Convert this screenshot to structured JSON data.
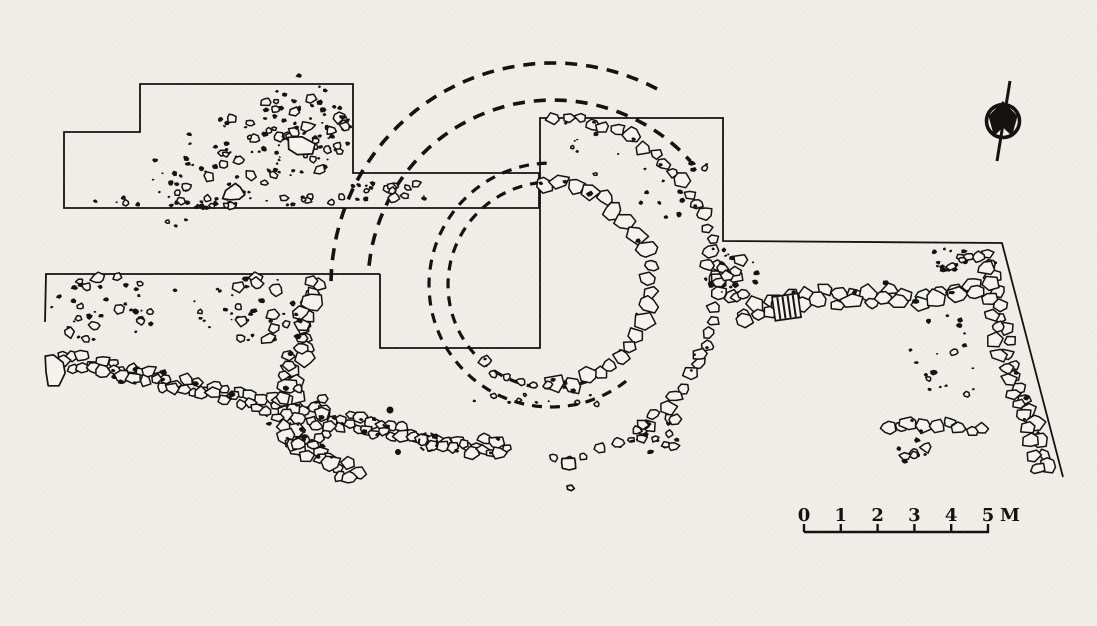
{
  "figure": {
    "type": "archaeological-excavation-site-plan",
    "ink": "#151310",
    "paper": "#f3f1ec",
    "stone_fill": "#f5f3ee",
    "elements": [
      "trench outlines",
      "stone walls",
      "circular stone structure",
      "reconstructed dashed circles",
      "north arrow",
      "scale bar"
    ]
  },
  "scale_bar": {
    "labels": [
      "0",
      "1",
      "2",
      "3",
      "4",
      "5"
    ],
    "unit": "M",
    "interval_m": 1,
    "total_m": 5
  },
  "drawing": {
    "shapes": [
      {
        "name": "outer-dashed-ring-outer",
        "kind": "dashedArc",
        "cx": 553,
        "cy": 285,
        "r": 222,
        "a0": 181,
        "a1": 300,
        "w": 3.6,
        "dash": "12 9"
      },
      {
        "name": "outer-dashed-ring-inner",
        "kind": "dashedArc",
        "cx": 553,
        "cy": 285,
        "r": 185,
        "a0": 186,
        "a1": 320,
        "w": 3.6,
        "dash": "12 9"
      },
      {
        "name": "inner-dashed-ring-outer",
        "kind": "dashedArc",
        "cx": 551,
        "cy": 285,
        "r": 122,
        "a0": 52,
        "a1": 268,
        "w": 3.2,
        "dash": "10 8"
      },
      {
        "name": "inner-dashed-ring-inner",
        "kind": "dashedArc",
        "cx": 551,
        "cy": 285,
        "r": 103,
        "a0": 58,
        "a1": 268,
        "w": 3.2,
        "dash": "10 8"
      },
      {
        "name": "trench-outline-northwest",
        "kind": "poly",
        "closed": true,
        "w": 1.8,
        "pts": [
          [
            140,
            84
          ],
          [
            353,
            84
          ],
          [
            353,
            173
          ],
          [
            539,
            173
          ],
          [
            539,
            208
          ],
          [
            64,
            208
          ],
          [
            64,
            132
          ],
          [
            140,
            132
          ]
        ]
      },
      {
        "name": "trench-outline-central",
        "kind": "poly",
        "closed": false,
        "w": 1.8,
        "pts": [
          [
            380,
            274
          ],
          [
            380,
            348
          ],
          [
            540,
            348
          ],
          [
            540,
            118
          ],
          [
            723,
            118
          ],
          [
            723,
            241
          ],
          [
            1002,
            243
          ],
          [
            1063,
            477
          ]
        ]
      },
      {
        "name": "trench-outline-southwest",
        "kind": "poly",
        "closed": false,
        "w": 1.8,
        "pts": [
          [
            45,
            322
          ],
          [
            46,
            274
          ],
          [
            380,
            274
          ]
        ]
      },
      {
        "name": "inner-ring-wall",
        "kind": "arcWall",
        "cx": 551,
        "cy": 285,
        "r": 100,
        "a0": 266,
        "a1": 450,
        "smin": 12,
        "smax": 19,
        "gap": 0.95,
        "black": 0.22,
        "seed": 11
      },
      {
        "name": "inner-ring-wall-sparse",
        "kind": "arcWall",
        "cx": 551,
        "cy": 285,
        "r": 103,
        "a0": 452,
        "a1": 502,
        "smin": 6,
        "smax": 11,
        "gap": 1.9,
        "black": 0.15,
        "seed": 12
      },
      {
        "name": "outer-ring-wall",
        "kind": "arcWall",
        "cx": 551,
        "cy": 285,
        "r": 167,
        "a0": 271,
        "a1": 388,
        "smin": 9,
        "smax": 15,
        "gap": 1.15,
        "black": 0.3,
        "seed": 13
      },
      {
        "name": "outer-ring-wall-lower",
        "kind": "arcWall",
        "cx": 551,
        "cy": 285,
        "r": 168,
        "a0": 388,
        "a1": 418,
        "smin": 10,
        "smax": 16,
        "gap": 1.05,
        "black": 0.25,
        "seed": 14
      },
      {
        "name": "outer-ring-wall-tail",
        "kind": "arcWall",
        "cx": 551,
        "cy": 285,
        "r": 173,
        "a0": 418,
        "a1": 450,
        "smin": 6,
        "smax": 11,
        "gap": 2.0,
        "black": 0.2,
        "seed": 15
      },
      {
        "name": "east-west-wall",
        "kind": "pathWall",
        "pts": [
          [
            742,
            318
          ],
          [
            765,
            308
          ],
          [
            790,
            300
          ],
          [
            815,
            294
          ],
          [
            845,
            298
          ],
          [
            875,
            295
          ],
          [
            905,
            299
          ],
          [
            935,
            296
          ],
          [
            960,
            290
          ],
          [
            980,
            285
          ]
        ],
        "smin": 11,
        "smax": 18,
        "gap": 1.15,
        "black": 0.28,
        "rows": 1.6,
        "seed": 16
      },
      {
        "name": "east-trench-wall",
        "kind": "pathWall",
        "pts": [
          [
            984,
            252
          ],
          [
            990,
            281
          ],
          [
            995,
            309
          ],
          [
            1001,
            337
          ],
          [
            1009,
            365
          ],
          [
            1017,
            392
          ],
          [
            1027,
            420
          ],
          [
            1037,
            448
          ],
          [
            1045,
            468
          ]
        ],
        "smin": 9,
        "smax": 15,
        "gap": 1.1,
        "black": 0.3,
        "rows": 1.5,
        "seed": 17
      },
      {
        "name": "southeast-wall",
        "kind": "pathWall",
        "pts": [
          [
            886,
            428
          ],
          [
            908,
            423
          ],
          [
            930,
            428
          ],
          [
            952,
            424
          ],
          [
            972,
            429
          ],
          [
            985,
            427
          ]
        ],
        "smin": 9,
        "smax": 15,
        "gap": 1.0,
        "black": 0.28,
        "rows": 1.3,
        "seed": 18
      },
      {
        "name": "southwest-diagonal-wall",
        "kind": "pathWall",
        "pts": [
          [
            62,
            360
          ],
          [
            100,
            368
          ],
          [
            140,
            377
          ],
          [
            180,
            386
          ],
          [
            220,
            394
          ],
          [
            260,
            402
          ],
          [
            300,
            411
          ],
          [
            340,
            420
          ],
          [
            380,
            429
          ],
          [
            420,
            437
          ],
          [
            455,
            443
          ],
          [
            490,
            448
          ],
          [
            510,
            451
          ]
        ],
        "smin": 8,
        "smax": 13,
        "gap": 0.92,
        "black": 0.3,
        "rows": 2,
        "seed": 19
      },
      {
        "name": "south-curved-wall",
        "kind": "pathWall",
        "pts": [
          [
            316,
            280
          ],
          [
            310,
            306
          ],
          [
            303,
            332
          ],
          [
            296,
            358
          ],
          [
            289,
            384
          ],
          [
            287,
            410
          ],
          [
            295,
            436
          ],
          [
            313,
            456
          ],
          [
            336,
            467
          ],
          [
            360,
            472
          ]
        ],
        "smin": 10,
        "smax": 17,
        "gap": 0.85,
        "black": 0.35,
        "rows": 2.4,
        "seed": 20
      },
      {
        "name": "nw-trench-debris",
        "kind": "bandScatter",
        "p1": [
          150,
          198
        ],
        "p2": [
          340,
          102
        ],
        "width": 85,
        "bits": 80,
        "stones": 26,
        "smin": 4,
        "smax": 11,
        "seed": 21
      },
      {
        "name": "nw-dense-cluster",
        "kind": "blobScatter",
        "cx": 295,
        "cy": 135,
        "rx": 52,
        "ry": 42,
        "bits": 40,
        "stones": 16,
        "smin": 4,
        "smax": 11,
        "seed": 35
      },
      {
        "name": "nw-trench-bottom-row",
        "kind": "bandScatter",
        "p1": [
          95,
          202
        ],
        "p2": [
          345,
          200
        ],
        "width": 10,
        "bits": 20,
        "stones": 12,
        "smin": 4,
        "smax": 8,
        "seed": 22
      },
      {
        "name": "nw-corridor-stones",
        "kind": "bandScatter",
        "p1": [
          352,
          194
        ],
        "p2": [
          432,
          190
        ],
        "width": 20,
        "bits": 12,
        "stones": 9,
        "smin": 5,
        "smax": 10,
        "seed": 23
      },
      {
        "name": "sw-trench-northwest-cluster",
        "kind": "blobScatter",
        "cx": 105,
        "cy": 308,
        "rx": 55,
        "ry": 34,
        "bits": 26,
        "stones": 14,
        "smin": 5,
        "smax": 12,
        "seed": 24
      },
      {
        "name": "sw-trench-mid-specks",
        "kind": "blobScatter",
        "cx": 205,
        "cy": 305,
        "rx": 40,
        "ry": 28,
        "bits": 10,
        "stones": 2,
        "smin": 4,
        "smax": 7,
        "seed": 25
      },
      {
        "name": "sw-trench-center-cluster",
        "kind": "blobScatter",
        "cx": 258,
        "cy": 312,
        "rx": 38,
        "ry": 38,
        "bits": 22,
        "stones": 10,
        "smin": 5,
        "smax": 12,
        "seed": 26
      },
      {
        "name": "south-wall-west-bulge",
        "kind": "blobScatter",
        "cx": 295,
        "cy": 420,
        "rx": 36,
        "ry": 34,
        "bits": 14,
        "stones": 12,
        "smin": 7,
        "smax": 14,
        "seed": 27
      },
      {
        "name": "ring-junction-cluster",
        "kind": "blobScatter",
        "cx": 731,
        "cy": 274,
        "rx": 27,
        "ry": 25,
        "bits": 16,
        "stones": 11,
        "smin": 7,
        "smax": 14,
        "seed": 28
      },
      {
        "name": "outer-ring-tail-cluster",
        "kind": "blobScatter",
        "cx": 655,
        "cy": 432,
        "rx": 24,
        "ry": 23,
        "bits": 8,
        "stones": 9,
        "smin": 6,
        "smax": 11,
        "seed": 29
      },
      {
        "name": "between-rings-specks",
        "kind": "bandScatter",
        "p1": [
          575,
          140
        ],
        "p2": [
          690,
          215
        ],
        "width": 40,
        "bits": 14,
        "stones": 2,
        "smin": 3,
        "smax": 5,
        "seed": 30
      },
      {
        "name": "north-corner-specks",
        "kind": "blobScatter",
        "cx": 697,
        "cy": 167,
        "rx": 10,
        "ry": 10,
        "bits": 4,
        "stones": 1,
        "smin": 4,
        "smax": 6,
        "seed": 36
      },
      {
        "name": "east-trench-inner-specks",
        "kind": "blobScatter",
        "cx": 945,
        "cy": 360,
        "rx": 38,
        "ry": 48,
        "bits": 16,
        "stones": 3,
        "smin": 4,
        "smax": 7,
        "seed": 31
      },
      {
        "name": "east-corner-cluster",
        "kind": "blobScatter",
        "cx": 951,
        "cy": 258,
        "rx": 20,
        "ry": 14,
        "bits": 14,
        "stones": 4,
        "smin": 5,
        "smax": 9,
        "seed": 32
      },
      {
        "name": "southeast-below-stones",
        "kind": "blobScatter",
        "cx": 920,
        "cy": 452,
        "rx": 26,
        "ry": 12,
        "bits": 5,
        "stones": 4,
        "smin": 5,
        "smax": 10,
        "seed": 33
      },
      {
        "name": "ring-bottom-specks",
        "kind": "bandScatter",
        "p1": [
          470,
          395
        ],
        "p2": [
          600,
          398
        ],
        "width": 14,
        "bits": 8,
        "stones": 5,
        "smin": 3,
        "smax": 6,
        "seed": 34
      },
      {
        "name": "hatched-stone",
        "kind": "hatchStone",
        "x": 772,
        "y": 297,
        "wd": 26,
        "ht": 24,
        "rot": -8
      },
      {
        "name": "large-corner-stone",
        "kind": "bigStone",
        "cx": 54,
        "cy": 369,
        "rx": 11,
        "ry": 16,
        "rot": 14,
        "seed": 41
      },
      {
        "name": "nw-diamond-stone",
        "kind": "bigStone",
        "cx": 300,
        "cy": 146,
        "rx": 14,
        "ry": 11,
        "rot": 40,
        "seed": 42
      },
      {
        "name": "nw-edge-stone",
        "kind": "bigStone",
        "cx": 234,
        "cy": 194,
        "rx": 11,
        "ry": 9,
        "rot": 10,
        "seed": 43
      },
      {
        "name": "isolated-stone-south",
        "kind": "bigStone",
        "cx": 569,
        "cy": 464,
        "rx": 9,
        "ry": 6,
        "rot": -15,
        "seed": 44
      },
      {
        "name": "isolated-pebble-south",
        "kind": "bigStone",
        "cx": 570,
        "cy": 488,
        "rx": 4,
        "ry": 3,
        "rot": 0,
        "seed": 45
      },
      {
        "name": "dashed-pebble-outline",
        "kind": "dashedArc",
        "cx": 428,
        "cy": 442,
        "r": 9,
        "a0": 0,
        "a1": 360,
        "w": 2,
        "dash": "5 4"
      },
      {
        "name": "speck-a",
        "kind": "dot",
        "cx": 398,
        "cy": 452,
        "r": 3
      },
      {
        "name": "speck-b",
        "kind": "dot",
        "cx": 390,
        "cy": 410,
        "r": 3.5
      }
    ]
  }
}
